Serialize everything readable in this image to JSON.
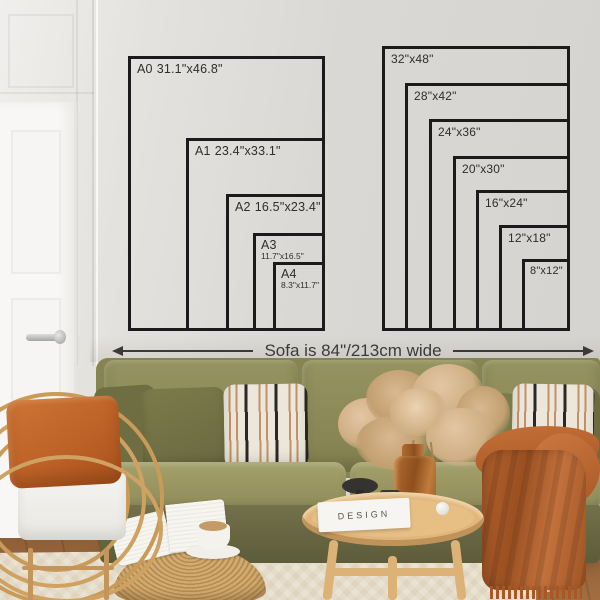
{
  "diagram": {
    "a_sizes": [
      {
        "name": "A0",
        "dims": "31.1\"x46.8\""
      },
      {
        "name": "A1",
        "dims": "23.4\"x33.1\""
      },
      {
        "name": "A2",
        "dims": "16.5\"x23.4\""
      },
      {
        "name": "A3",
        "dims": "11.7\"x16.5\""
      },
      {
        "name": "A4",
        "dims": "8.3\"x11.7\""
      }
    ],
    "inch_sizes": [
      {
        "label": "32\"x48\""
      },
      {
        "label": "28\"x42\""
      },
      {
        "label": "24\"x36\""
      },
      {
        "label": "20\"x30\""
      },
      {
        "label": "16\"x24\""
      },
      {
        "label": "12\"x18\""
      },
      {
        "label": "8\"x12\""
      }
    ],
    "sofa_note": "Sofa is 84\"/213cm wide"
  },
  "decor": {
    "book_title": "DESIGN"
  },
  "colors": {
    "outline": "#1b1b1b",
    "label_text": "#2e2e2e",
    "wall": "#dcdad6",
    "sofa_olive": "#868450",
    "accent_rust": "#b5622e",
    "rattan": "#c99b59"
  }
}
